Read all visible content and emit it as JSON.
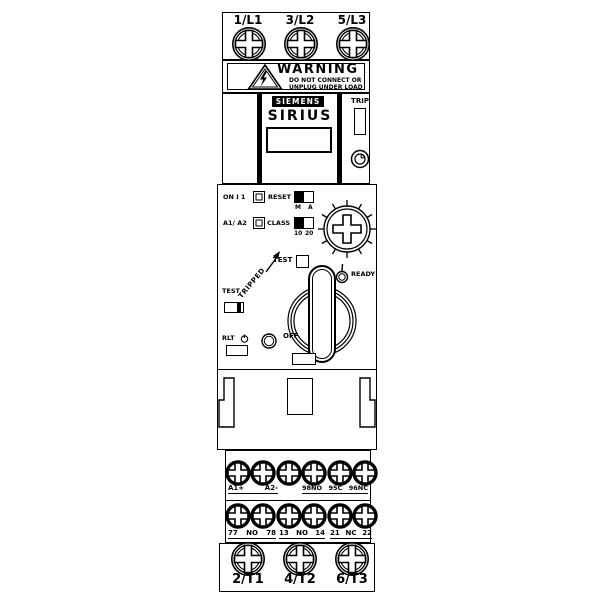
{
  "top_terminals": {
    "labels": [
      "1/L1",
      "3/L2",
      "5/L3"
    ]
  },
  "warning": {
    "title": "WARNING",
    "line1": "DO NOT CONNECT OR",
    "line2": "UNPLUG UNDER LOAD"
  },
  "brand": {
    "logo": "SIEMENS",
    "product": "SIRIUS"
  },
  "indicator": {
    "trip": "TRIP",
    "reset": "RESET"
  },
  "controls": {
    "on_label": "ON I 1",
    "reset_label": "RESET",
    "reset_m": "M",
    "reset_a": "A",
    "a1a2_label": "A1/ A2",
    "class_label": "CLASS",
    "class_10": "10",
    "class_20": "20",
    "test_top": "TEST",
    "tripped": "TRIPPED",
    "ready": "READY",
    "off": "OFF",
    "test_side": "TEST",
    "rlt": "RLT"
  },
  "terminals": {
    "row1": [
      "A1+",
      "A2-",
      "98NO",
      "95C",
      "96NC"
    ],
    "row2": [
      "77",
      "NO",
      "78",
      "13",
      "NO",
      "14",
      "21",
      "NC",
      "22"
    ],
    "bottom": [
      "2/T1",
      "4/T2",
      "6/T3"
    ]
  }
}
